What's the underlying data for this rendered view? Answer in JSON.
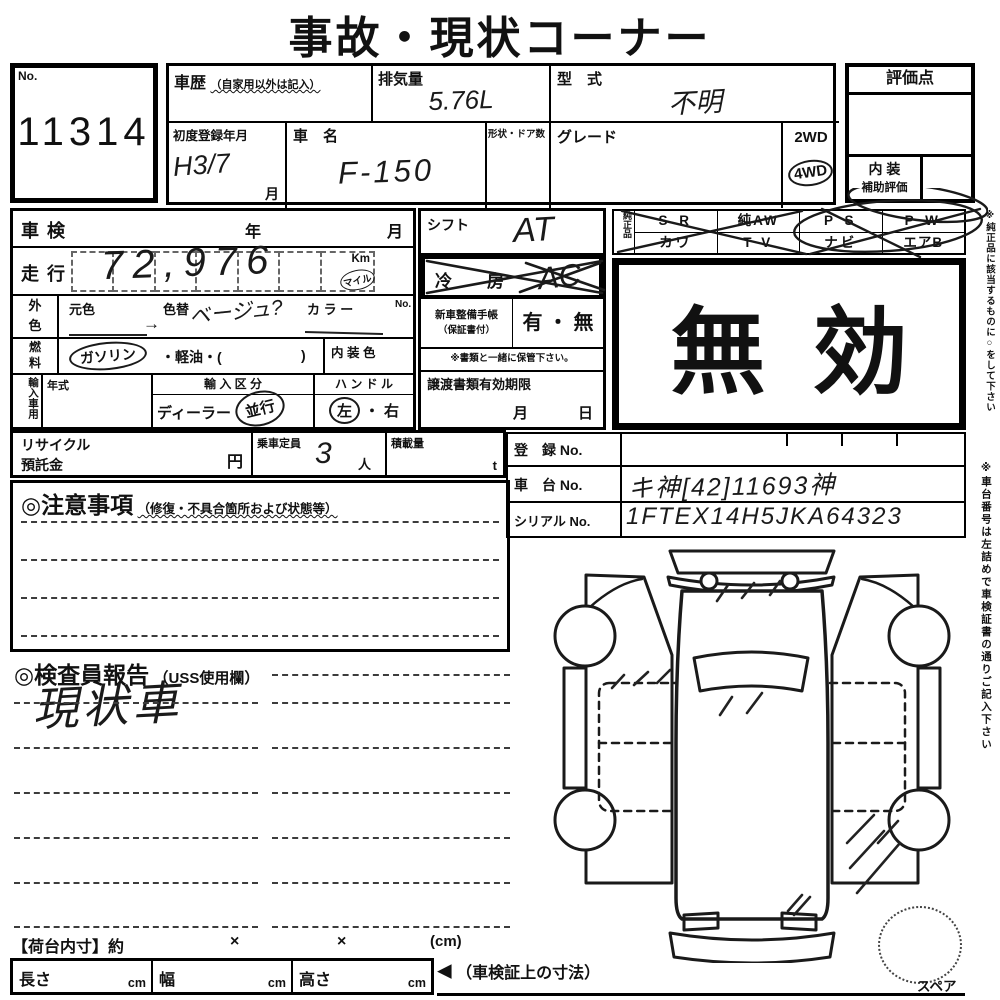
{
  "title": "事故・現状コーナー",
  "no_box": {
    "label": "No.",
    "value": "11314"
  },
  "top": {
    "history_label": "車歴",
    "history_note": "（自家用以外は記入）",
    "displacement_label": "排気量",
    "displacement_value": "5.76L",
    "model_label": "型　式",
    "model_value": "不明",
    "first_reg_label": "初度登録年月",
    "first_reg_value": "H3/7",
    "first_reg_unit": "月",
    "car_name_label": "車　名",
    "car_name_value": "F-150",
    "shape_doors_label": "形状・ドア数",
    "grade_label": "グレード",
    "drive_2wd": "2WD",
    "drive_4wd": "4WD"
  },
  "score_box": {
    "header": "評価点",
    "interior_label": "内 装",
    "interior_sub": "補助評価"
  },
  "inspection_row": {
    "label": "車検",
    "year": "年",
    "month": "月"
  },
  "mileage_row": {
    "label": "走行",
    "value": "72,976",
    "unit_km": "Km",
    "unit_mile": "マイル"
  },
  "color_row": {
    "label_top": "外",
    "label_bottom": "色",
    "original": "元色",
    "repaint": "色替",
    "repaint_value": "ベージュ?",
    "color_label": "カ ラ ー",
    "color_no": "No.",
    "arrow": "→"
  },
  "fuel_row": {
    "label_top": "燃",
    "label_bottom": "料",
    "gasoline": "ガソリン",
    "others": "・軽油・(",
    "close_paren": ")",
    "interior_color_label": "内 装 色"
  },
  "import_row": {
    "label": "輸入車用",
    "year_label": "年式",
    "class_label": "輸 入 区 分",
    "dealer": "ディーラー",
    "parallel": "並行",
    "handle_label": "ハ ン ド ル",
    "left": "左",
    "separator": "・",
    "right": "右"
  },
  "recycle_row": {
    "label_line1": "リサイクル",
    "label_line2": "預託金",
    "yen": "円",
    "capacity_label": "乗車定員",
    "capacity_value": "3",
    "capacity_unit": "人",
    "load_label": "積載量",
    "load_unit": "t"
  },
  "shift_row": {
    "label": "シフト",
    "value": "AT"
  },
  "aircon_row": {
    "label_left": "冷",
    "label_right": "房",
    "value": "AC"
  },
  "notebook_row": {
    "label_line1": "新車整備手帳",
    "label_line2": "（保証書付）",
    "options": "有 ・ 無",
    "note": "※書類と一緒に保管下さい。"
  },
  "transfer_row": {
    "label": "譲渡書類有効期限",
    "month": "月",
    "day": "日"
  },
  "genuine": {
    "label": "純正品",
    "row1": [
      "S R",
      "純AW",
      "P S",
      "P W"
    ],
    "row2": [
      "カワ",
      "T V",
      "ナビ",
      "エアB"
    ]
  },
  "void_stamp": {
    "char1": "無",
    "char2": "効"
  },
  "registry": {
    "reg_label": "登　録 No.",
    "chassis_label": "車　台 No.",
    "chassis_value": "キ神[42]11693神",
    "serial_label": "シリアル No.",
    "serial_value": "1FTEX14H5JKA64323"
  },
  "caution": {
    "heading": "◎注意事項",
    "note": "（修復・不具合箇所および状態等）"
  },
  "inspector": {
    "heading": "◎検査員報告",
    "note": "（USS使用欄）",
    "value": "現状車"
  },
  "bed_row": {
    "label": "【荷台内寸】約",
    "x1": "×",
    "x2": "×",
    "unit": "(cm)"
  },
  "dims_row": {
    "length_label": "長さ",
    "width_label": "幅",
    "height_label": "高さ",
    "cm": "cm",
    "arrow": "◀",
    "note": "（車検証上の寸法）"
  },
  "spare": {
    "label": "スペア"
  },
  "side_notes": {
    "note1": "※純正品に該当するものに○をして下さい",
    "note2": "※車台番号は左詰めで車検証書の通りご記入下さい"
  }
}
